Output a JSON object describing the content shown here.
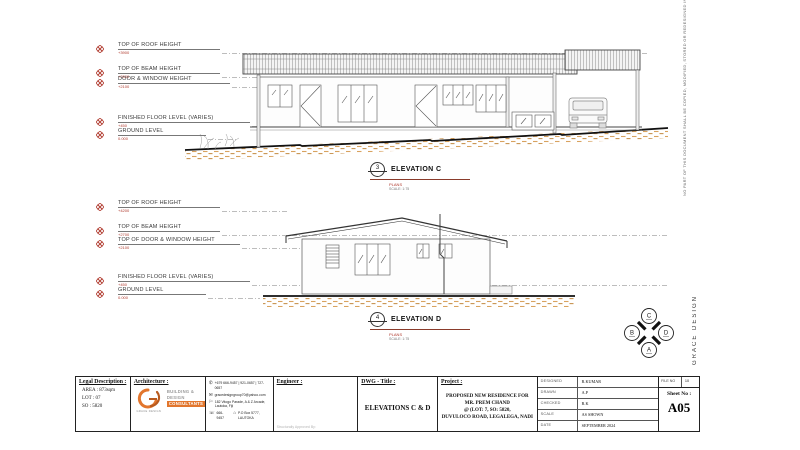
{
  "colors": {
    "accent_red": "#b03a2e",
    "earth_tan": "#d8a35f",
    "logo_orange": "#e2762d"
  },
  "sheet": {
    "disclaimer_vertical": "NO PART OF THIS DOCUMENT SHALL BE COPIED, MODIFIED, STORED OR REDESIGNED IN ANY RELEVANT SYSTEM WITHOUT THE CONCERNS OF",
    "brand_vertical": "GRACE DESIGN",
    "compass": {
      "top": "C",
      "left": "B",
      "right": "D",
      "bottom": "A"
    }
  },
  "elevation_c": {
    "callout_number": "3",
    "title": "ELEVATION C",
    "subtitle": "PLANS",
    "scale": "SCALE: 1:75",
    "levels": [
      {
        "label": "TOP OF ROOF HEIGHT",
        "value": "+3900"
      },
      {
        "label": "TOP OF BEAM HEIGHT",
        "value": "+2800"
      },
      {
        "label": "DOOR & WINDOW HEIGHT",
        "value": "+2100"
      },
      {
        "label": "FINISHED FLOOR LEVEL (VARIES)",
        "value": "+450"
      },
      {
        "label": "GROUND LEVEL",
        "value": "0.000"
      }
    ]
  },
  "elevation_d": {
    "callout_number": "4",
    "title": "ELEVATION D",
    "subtitle": "PLANS",
    "scale": "SCALE: 1:75",
    "levels": [
      {
        "label": "TOP OF ROOF HEIGHT",
        "value": "+4200"
      },
      {
        "label": "TOP OF BEAM HEIGHT",
        "value": "+2700"
      },
      {
        "label": "TOP OF DOOR & WINDOW HEIGHT",
        "value": "+2100"
      },
      {
        "label": "FINISHED FLOOR LEVEL (VARIES)",
        "value": "+450"
      },
      {
        "label": "GROUND LEVEL",
        "value": "0.000"
      }
    ]
  },
  "titleblock": {
    "legal": {
      "header": "Legal Description :",
      "rows": [
        "AREA :  873sqm",
        "LOT    :  07",
        "SO     :  5820"
      ]
    },
    "architecture": {
      "header": "Architecture :",
      "logo_caption": "GRACE DESIGN",
      "tagline": [
        "BUILDING &",
        "DESIGN",
        "CONSULTANTS"
      ],
      "contacts": [
        {
          "icon": "phone-icon",
          "glyph": "✆",
          "text": "+679 666-9457 | 921-0657 | 727-0657"
        },
        {
          "icon": "email-icon",
          "glyph": "✉",
          "text": "gracedesigngroup70@yahoo.com"
        },
        {
          "icon": "location-icon",
          "glyph": "⚐",
          "text": "182 Vitogo Parade, A & Z Arcade, Lautoka, Fiji"
        },
        {
          "icon": "fax-icon",
          "glyph": "☏",
          "text": "666-9457"
        },
        {
          "icon": "pobox-icon",
          "glyph": "⌂",
          "text": "P.O Box 5777, LAUTOKA"
        }
      ]
    },
    "engineer": {
      "header": "Engineer :",
      "footnote": "Structurally Approved By:"
    },
    "dwg": {
      "header": "DWG - Title :",
      "title": "ELEVATIONS C & D"
    },
    "project": {
      "header": "Project :",
      "lines": [
        "PROPOSED NEW RESIDENCE FOR",
        "MR. PREM CHAND",
        "@ (LOT: 7, SO: 5820,",
        "DUVULOCO ROAD, LEGALEGA, NADI"
      ]
    },
    "meta": [
      {
        "label": "DESIGNED",
        "value": "R.KUMAR"
      },
      {
        "label": "DRAWN",
        "value": "A.P"
      },
      {
        "label": "CHECKED",
        "value": "R.K"
      },
      {
        "label": "SCALE",
        "value": "AS SHOWN"
      },
      {
        "label": "DATE",
        "value": "SEPTEMBER 2024"
      }
    ],
    "file": {
      "label": "FILE NO",
      "value": "10"
    },
    "sheet_no": {
      "label": "Sheet No :",
      "value": "A05"
    }
  }
}
